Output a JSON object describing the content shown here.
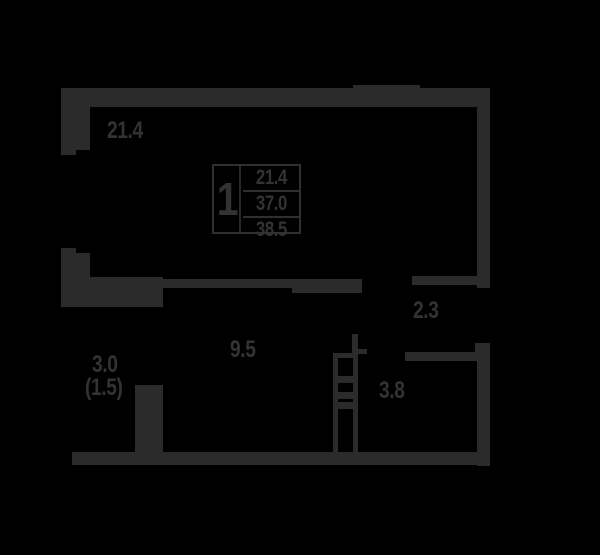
{
  "colors": {
    "background": "#000000",
    "walls": "#2b2b2b",
    "text": "#333333"
  },
  "unit_table": {
    "rooms_count": "1",
    "values": [
      "21.4",
      "37.0",
      "38.5"
    ]
  },
  "labels": {
    "living_room": "21.4",
    "hall": "2.3",
    "kitchen": "9.5",
    "balcony": "3.0",
    "balcony_coeff": "(1.5)",
    "bathroom": "3.8"
  }
}
